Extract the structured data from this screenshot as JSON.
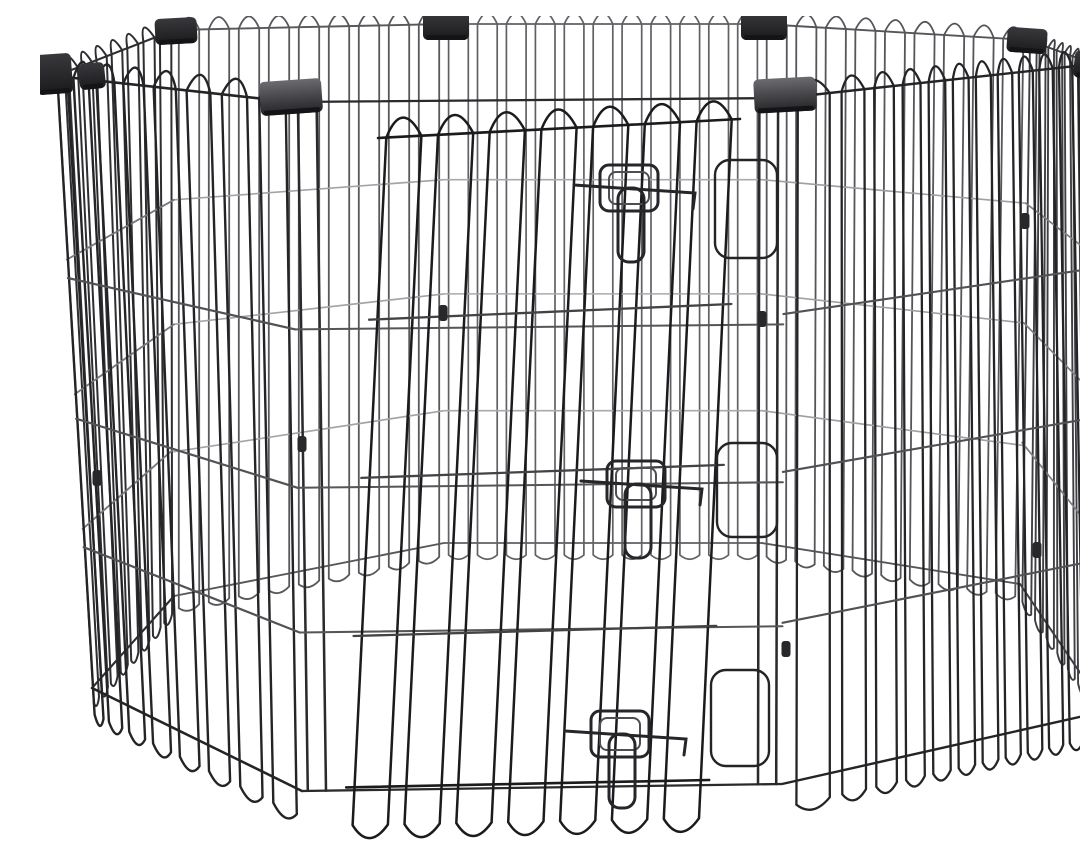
{
  "image": {
    "description": "Black metal 8-panel foldable pet exercise playpen with arched wire loop tops, dark plastic corner hinge caps, and a walk-through door secured by three wire slide-bolt latches, photographed on a plain white background",
    "background_color": "#ffffff"
  },
  "palette": {
    "background": "#ffffff",
    "wire_darkest": "#1b1b1d",
    "wire_dark": "#242427",
    "wire_mid": "#3f3f43",
    "wire_back": "#5a5a5e",
    "wire_light": "#9b9b9f",
    "latch": "#26262a",
    "latch_inner": "#4e4e52",
    "clip": "#28282a",
    "cap_big_top": "#6b6b70",
    "cap_big_mid": "#4a4a4e",
    "cap_big_bottom": "#232326",
    "cap_small_top": "#39393d",
    "cap_small_bottom": "#1a1a1c",
    "cap_lip": "#141416"
  },
  "scene": {
    "canvas": {
      "width": 1080,
      "height": 829
    },
    "panels": [
      {
        "name": "panel-back-left",
        "quad": [
          [
            134,
            14
          ],
          [
            404,
            8
          ],
          [
            404,
            527
          ],
          [
            134,
            580
          ]
        ],
        "loops": 9,
        "bias": 1,
        "color": "#58585c",
        "hColor": "#a4a4a8",
        "sw": 1.8,
        "archH": 12,
        "drop": 13,
        "fractions": [
          0.3,
          0.52,
          0.745
        ]
      },
      {
        "name": "panel-back-center",
        "quad": [
          [
            404,
            8
          ],
          [
            722,
            8
          ],
          [
            722,
            527
          ],
          [
            404,
            527
          ]
        ],
        "loops": 11,
        "bias": 1,
        "color": "#616165",
        "hColor": "#aaaaae",
        "sw": 1.7,
        "archH": 11,
        "drop": 12,
        "fractions": [
          0.3,
          0.52,
          0.745
        ]
      },
      {
        "name": "panel-back-right",
        "quad": [
          [
            722,
            8
          ],
          [
            988,
            24
          ],
          [
            980,
            568
          ],
          [
            722,
            527
          ]
        ],
        "loops": 9,
        "bias": 1,
        "color": "#55555a",
        "hColor": "#a0a0a4",
        "sw": 1.8,
        "archH": 12,
        "drop": 13,
        "fractions": [
          0.3,
          0.52,
          0.745
        ]
      },
      {
        "name": "panel-left-side",
        "quad": [
          [
            16,
            60
          ],
          [
            134,
            14
          ],
          [
            134,
            580
          ],
          [
            52,
            672
          ]
        ],
        "loops": 8,
        "bias": 1.15,
        "color": "#2e2e31",
        "hColor": "#78787c",
        "sw": 2.0,
        "archH": 13,
        "drop": 16,
        "fractions": [
          0.3,
          0.52,
          0.74
        ]
      },
      {
        "name": "panel-right-side",
        "quad": [
          [
            988,
            24
          ],
          [
            1054,
            48
          ],
          [
            1066,
            695
          ],
          [
            980,
            568
          ]
        ],
        "loops": 8,
        "bias": 0.9,
        "color": "#3f3f43",
        "hColor": "#808084",
        "sw": 1.9,
        "archH": 9,
        "drop": 14,
        "fractions": [
          0.3,
          0.52,
          0.74
        ]
      },
      {
        "name": "panel-front-right",
        "quad": [
          [
            744,
            82
          ],
          [
            1054,
            48
          ],
          [
            1066,
            695
          ],
          [
            742,
            768
          ]
        ],
        "loops": 12,
        "bias": 0.72,
        "color": "#242427",
        "hColor": "#525256",
        "sw": 2.3,
        "archH": 15,
        "drop": 24,
        "fractions": [
          0.315,
          0.545,
          0.765
        ]
      },
      {
        "name": "panel-front-left",
        "quad": [
          [
            16,
            60
          ],
          [
            252,
            86
          ],
          [
            262,
            775
          ],
          [
            52,
            672
          ]
        ],
        "loops": 8,
        "bias": 1.35,
        "color": "#242427",
        "hColor": "#525256",
        "sw": 2.4,
        "archH": 17,
        "drop": 26,
        "fractions": [
          0.33,
          0.56,
          0.77
        ]
      },
      {
        "name": "panel-front-frame",
        "quad": [
          [
            252,
            86
          ],
          [
            744,
            82
          ],
          [
            742,
            768
          ],
          [
            262,
            775
          ]
        ],
        "loops": 0,
        "bias": 1,
        "color": "#2a2a2d",
        "hColor": "#565659",
        "sw": 2.2,
        "archH": 0,
        "drop": 0,
        "fractions": [
          0.33,
          0.56,
          0.77
        ],
        "verticalsAt": [
          0.012,
          0.05,
          0.95,
          0.988
        ]
      },
      {
        "name": "panel-door",
        "quad": [
          [
            338,
            122
          ],
          [
            700,
            103
          ],
          [
            668,
            788
          ],
          [
            305,
            795
          ]
        ],
        "loops": 7,
        "bias": 1,
        "color": "#1b1b1d",
        "hColor": "#434346",
        "sw": 2.5,
        "archH": 19,
        "drop": 38,
        "bottomRailV": 0.965,
        "fractions": [
          0.27,
          0.505,
          0.74
        ]
      }
    ],
    "hinges": [
      {
        "name": "door-hinge-loop-top",
        "cx": 706,
        "cy": 193,
        "w": 62,
        "h": 98
      },
      {
        "name": "door-hinge-loop-middle",
        "cx": 707,
        "cy": 474,
        "w": 60,
        "h": 94
      },
      {
        "name": "door-hinge-loop-bottom",
        "cx": 700,
        "cy": 702,
        "w": 58,
        "h": 96
      }
    ],
    "caps": [
      {
        "name": "corner-cap-far-left",
        "x": 14,
        "y": 38,
        "w": 36,
        "h": 40,
        "style": "small",
        "angle": -4
      },
      {
        "name": "corner-cap-far-left-2",
        "x": 52,
        "y": 47,
        "w": 26,
        "h": 26,
        "style": "small",
        "angle": -6
      },
      {
        "name": "corner-cap-back-left",
        "x": 136,
        "y": 2,
        "w": 42,
        "h": 26,
        "style": "small",
        "angle": -3
      },
      {
        "name": "corner-cap-back-center-left",
        "x": 406,
        "y": -4,
        "w": 46,
        "h": 28,
        "style": "small",
        "angle": 0
      },
      {
        "name": "corner-cap-back-center-right",
        "x": 724,
        "y": -4,
        "w": 46,
        "h": 28,
        "style": "small",
        "angle": 0
      },
      {
        "name": "corner-cap-back-right",
        "x": 987,
        "y": 12,
        "w": 40,
        "h": 25,
        "style": "small",
        "angle": 4
      },
      {
        "name": "corner-cap-far-right",
        "x": 1054,
        "y": 36,
        "w": 40,
        "h": 27,
        "style": "small",
        "angle": 6
      },
      {
        "name": "corner-cap-front-left",
        "x": 251,
        "y": 64,
        "w": 62,
        "h": 34,
        "style": "big",
        "angle": -4
      },
      {
        "name": "corner-cap-front-right",
        "x": 745,
        "y": 62,
        "w": 62,
        "h": 34,
        "style": "big",
        "angle": -3
      }
    ],
    "clips": [
      {
        "name": "wire-clip",
        "x": 57,
        "y": 462
      },
      {
        "name": "wire-clip",
        "x": 403,
        "y": 297
      },
      {
        "name": "wire-clip",
        "x": 722,
        "y": 303
      },
      {
        "name": "wire-clip",
        "x": 985,
        "y": 205
      },
      {
        "name": "wire-clip",
        "x": 1059,
        "y": 448
      },
      {
        "name": "wire-clip",
        "x": 997,
        "y": 534
      },
      {
        "name": "wire-clip",
        "x": 262,
        "y": 428
      },
      {
        "name": "wire-clip",
        "x": 746,
        "y": 633
      }
    ],
    "latches": [
      {
        "name": "door-latch-top",
        "x": 589,
        "y": 176
      },
      {
        "name": "door-latch-middle",
        "x": 596,
        "y": 472
      },
      {
        "name": "door-latch-bottom",
        "x": 580,
        "y": 722
      }
    ]
  }
}
